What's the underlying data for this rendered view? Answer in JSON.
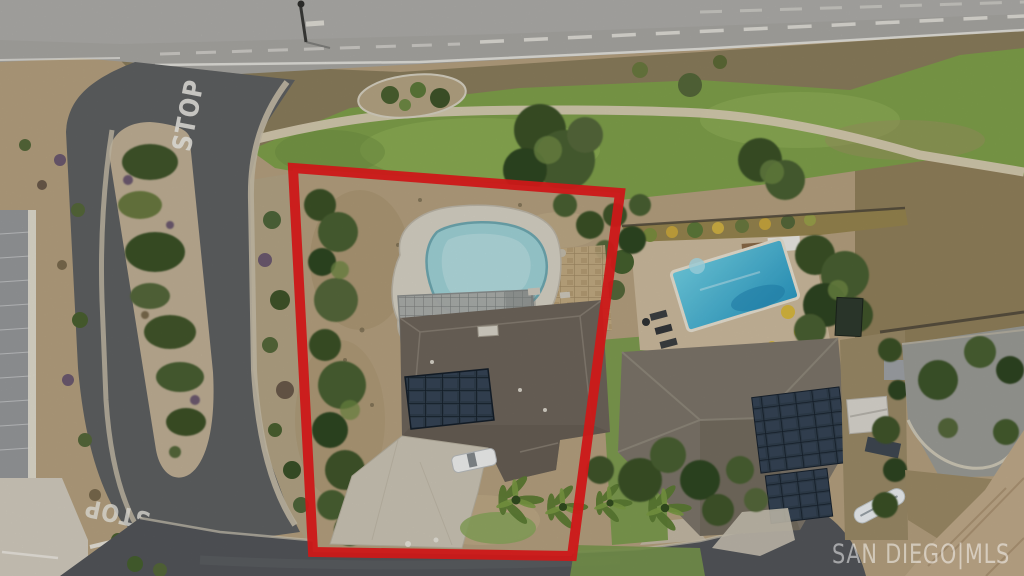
{
  "scene": {
    "type": "aerial-drone-photo",
    "subject": "residential lot outlined in red with pool, solar roof and driveway",
    "width_px": 1024,
    "height_px": 576
  },
  "road_markings": {
    "stop_north": "STOP",
    "stop_south": "STOP"
  },
  "watermark": {
    "text": "SAN DIEGO|MLS"
  },
  "colors": {
    "boundary_red": "#e31b1b",
    "main_road": "#a8a7a3",
    "local_street": "#5e6062",
    "bottom_road": "#53565a",
    "grass": "#7fa04b",
    "dirt": "#b5a17f",
    "brush_dirt": "#8a7d5c",
    "subject_pool_water": "#9fd3d8",
    "subject_pool_deck": "#d7d2c5",
    "neighbor_pool_deep": "#2b9ac4",
    "neighbor_pool_shallow": "#6fd0e4",
    "subject_roof": "#6e655b",
    "neighbor_roof": "#7d766a",
    "far_roof": "#c0aa8a",
    "solar_panel": "#2f3d4c",
    "driveway_concrete": "#ccc5b5",
    "walking_path": "#d8cdb3",
    "paint_white": "#f0efe9",
    "median_soil": "#c0b096",
    "tree_dark": "#3a5128",
    "tree_mid": "#4a6130",
    "tree_light": "#6f8a45"
  },
  "features": [
    "subject-property-boundary",
    "subject-pool-with-spa",
    "subject-house-roof",
    "subject-solar-array",
    "subject-driveway",
    "parked-white-car",
    "palm-trees",
    "screened-patio",
    "neighbor-pool",
    "neighbor-house-roof",
    "neighbor-solar-array",
    "storage-shed",
    "boat-on-trailer",
    "median-planter",
    "stop-pavement-marking-north",
    "stop-pavement-marking-south",
    "walking-path",
    "greenbelt",
    "main-road",
    "local-street",
    "streetlight",
    "mls-watermark"
  ]
}
